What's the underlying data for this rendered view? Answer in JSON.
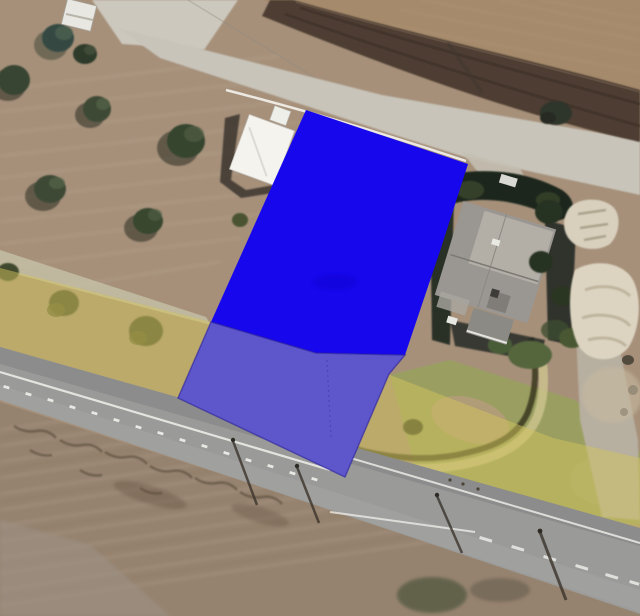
{
  "scene": {
    "type": "satellite-aerial-view",
    "description": "Aerial imagery of rural parcels with a highlighted parcel polygon overlay and a translucent zoning band along the main road",
    "width": 640,
    "height": 616
  },
  "overlays": {
    "parcel": {
      "label": "highlighted-parcel",
      "fill_opaque": "#1607EC",
      "fill_shaded": "#5D57CB",
      "edge_color": "#2B1F9C",
      "points_upper": "306,110 468,164 441,248 405,355 316,353 211,322",
      "points_lower": "211,322 316,353 405,355 389,374 345,477 178,398",
      "divider_points": "327,360 329,400 331,438"
    },
    "zone_band": {
      "label": "zoning-band",
      "fill": "#D2C45C",
      "opacity": "0.5",
      "points": "0,268 211,322 390,375 553,438 640,458 640,530 420,483 230,422 0,350"
    }
  },
  "terrain_colors": {
    "field_base": "#A6907A",
    "field_top_right": "#A58A6B",
    "field_bottom": "#96836F",
    "plowed_strip": "#4E3E33",
    "pale_road": "#C8C4B9",
    "main_road": "#9A9B99",
    "lawn_green": "#99A15E",
    "house_roof": "#9A9792",
    "barn_roof": "#F4F3EE",
    "rock_outcrop": "#D9D1BF",
    "tree_dark": "#2E3A2B",
    "road_marking": "#F2F1EC"
  }
}
